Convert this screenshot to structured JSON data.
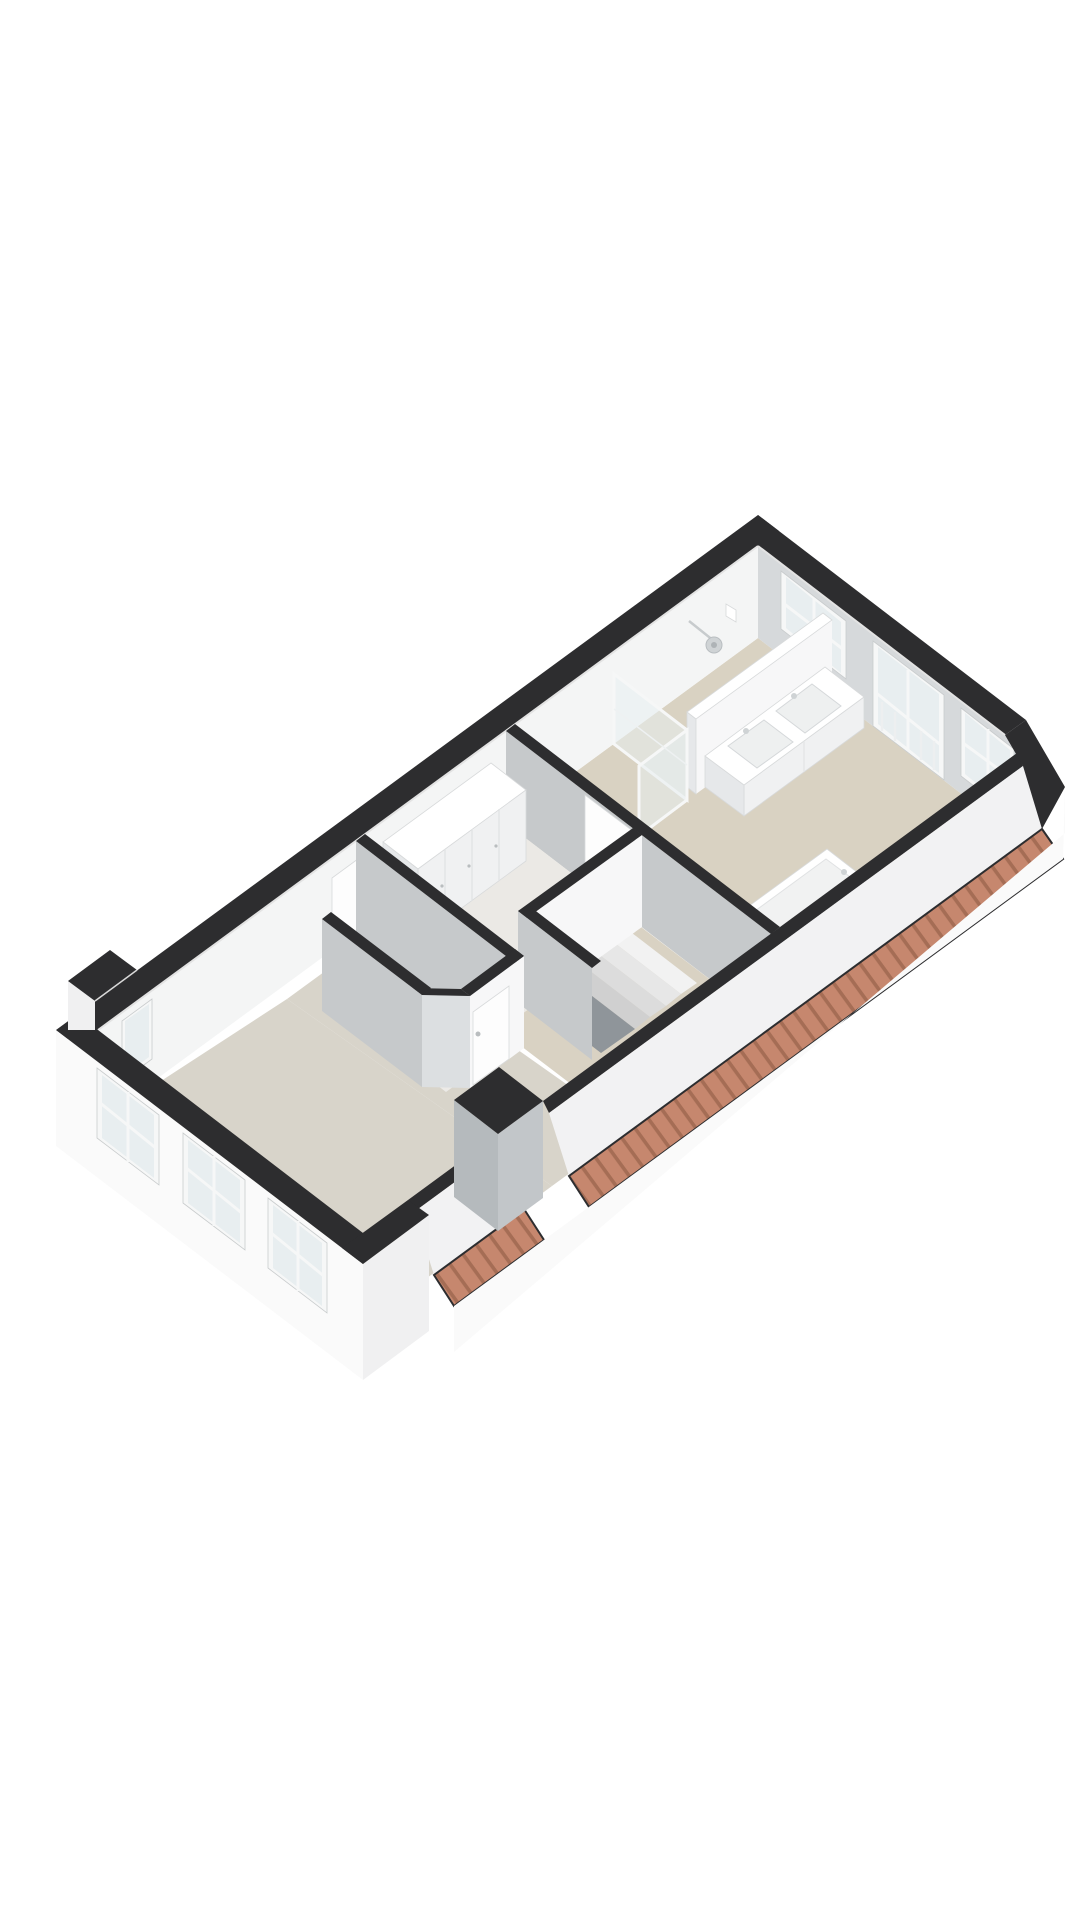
{
  "scene": {
    "type": "3D floor plan render",
    "projection": "axonometric bird's-eye view, plan rotated ~45 degrees",
    "background": "#ffffff",
    "description": "Single attic storey dollhouse render: dark cut-off wall tops, white exterior walls, beige floors, terracotta tiled roof eaves along the lower-right side"
  },
  "colors": {
    "bg": "#ffffff",
    "wall_top": "#2d2d2f",
    "int_face_ne": "#d6d9db",
    "int_face_bright": "#f4f5f5",
    "face_se": "#f7f7f8",
    "face_sw": "#c6c9cb",
    "ext_face": "#fafafa",
    "ext_face_shade": "#f0f0f1",
    "slope_white": "#f2f2f3",
    "floor_bath": "#d9d2c2",
    "floor_hall": "#ebe9e5",
    "floor_landing": "#d9d2c3",
    "floor_toilet_zone": "#e2dfd8",
    "floor_toilet": "#eceae7",
    "floor_main": "#d8d4ca",
    "stair_void": "#8f959a",
    "tread1": "#f2f2f2",
    "tread2": "#e7e7e7",
    "tread3": "#dcdcdc",
    "tread4": "#d0d0d0",
    "glass": "#e8eef0",
    "frame": "#f6f7f7",
    "door_white": "#fdfdfd",
    "furniture_white": "#ffffff",
    "furniture_side": "#f0f1f2",
    "furniture_shade": "#e6e8ea",
    "furniture_edge": "#d8dadb",
    "fixture_gray": "#cfd3d5",
    "roof_tile": "#c6876e",
    "roof_tile_dark": "#a56d55",
    "chimney_se": "#c2c6c9",
    "chimney_sw": "#b5babd"
  },
  "rooms": [
    {
      "id": "bathroom",
      "label": "Bathroom",
      "position": "upper / north-east end",
      "floor_color": "#d9d2c2",
      "contents": [
        "double-basin vanity",
        "walk-in shower with rain head",
        "glass shower screen",
        "bathtub"
      ]
    },
    {
      "id": "hallway",
      "label": "Hallway landing",
      "position": "centre",
      "floor_color": "#ebe9e5",
      "contents": [
        "built-in wardrobe with 4 doors",
        "interior doors"
      ]
    },
    {
      "id": "stairwell",
      "label": "Stairwell",
      "position": "centre, towards south-east wall",
      "floor_color": "#8f959a",
      "contents": [
        "staircase, 4 visible treads descending"
      ]
    },
    {
      "id": "toilet",
      "label": "Small room (toilet / storage)",
      "position": "between hallway and main room",
      "floor_color": "#eceae7",
      "contents": [
        "door with handle"
      ]
    },
    {
      "id": "main-room",
      "label": "Main room (living / bedroom)",
      "position": "lower / south-west end",
      "floor_color": "#d8d4ca",
      "contents": []
    }
  ],
  "windows": {
    "north_east_facade": [
      "sash window",
      "glazed french balcony doors with railing bars",
      "sash window"
    ],
    "south_west_facade": [
      "window",
      "window",
      "window"
    ],
    "north_west_facade": [
      "narrow window near west corner"
    ]
  },
  "roof": {
    "eaves": "terracotta ribbed tile strip along the full south-east eaves and wrapped around the east corner chamfer",
    "tile_color": "#c6876e",
    "interruptions": [
      "chimney block",
      "full-height wall section at south corner"
    ]
  },
  "fixtures": {
    "vanity_basins": 2,
    "bathtub": 1,
    "shower_head": 1,
    "wardrobe_doors": 4,
    "interior_door_leaves": 3,
    "stair_treads_visible": 4
  }
}
